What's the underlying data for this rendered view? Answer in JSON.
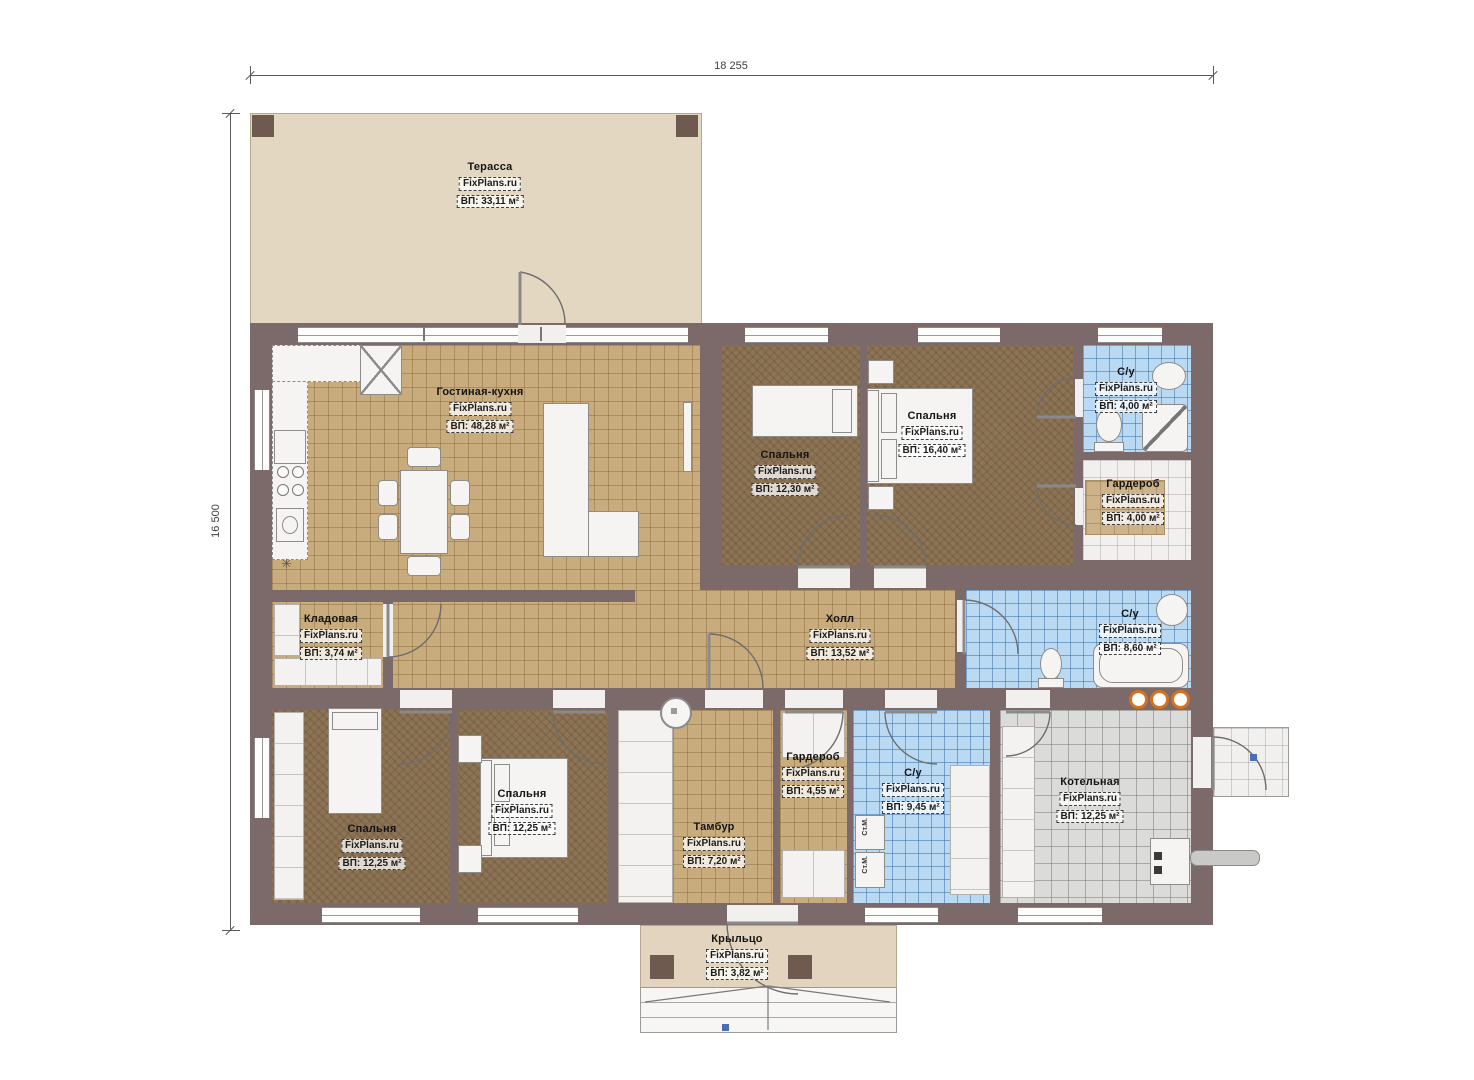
{
  "plan": {
    "dimensions": {
      "top": "18 255",
      "left": "16 500"
    },
    "rooms": [
      {
        "id": "terrace",
        "name": "Терасса",
        "brand": "FixPlans.ru",
        "area": "ВП: 33,11 м²"
      },
      {
        "id": "living-kitchen",
        "name": "Гостиная-кухня",
        "brand": "FixPlans.ru",
        "area": "ВП: 48,28 м²"
      },
      {
        "id": "bedroom-top-left",
        "name": "Спальня",
        "brand": "FixPlans.ru",
        "area": "ВП: 12,30 м²"
      },
      {
        "id": "bedroom-master",
        "name": "Спальня",
        "brand": "FixPlans.ru",
        "area": "ВП: 16,40 м²"
      },
      {
        "id": "bathroom-master",
        "name": "С/у",
        "brand": "FixPlans.ru",
        "area": "ВП: 4,00 м²"
      },
      {
        "id": "wardrobe-master",
        "name": "Гардероб",
        "brand": "FixPlans.ru",
        "area": "ВП: 4,00 м²"
      },
      {
        "id": "pantry",
        "name": "Кладовая",
        "brand": "FixPlans.ru",
        "area": "ВП: 3,74 м²"
      },
      {
        "id": "hall",
        "name": "Холл",
        "brand": "FixPlans.ru",
        "area": "ВП: 13,52 м²"
      },
      {
        "id": "bathroom-main",
        "name": "С/у",
        "brand": "FixPlans.ru",
        "area": "ВП: 8,60 м²"
      },
      {
        "id": "bedroom-bottom-left",
        "name": "Спальня",
        "brand": "FixPlans.ru",
        "area": "ВП: 12,25 м²"
      },
      {
        "id": "bedroom-bottom-mid",
        "name": "Спальня",
        "brand": "FixPlans.ru",
        "area": "ВП: 12,25 м²"
      },
      {
        "id": "wardrobe-bottom",
        "name": "Гардероб",
        "brand": "FixPlans.ru",
        "area": "ВП: 4,55 м²"
      },
      {
        "id": "vestibule",
        "name": "Тамбур",
        "brand": "FixPlans.ru",
        "area": "ВП: 7,20 м²"
      },
      {
        "id": "bathroom-laundry",
        "name": "С/у",
        "brand": "FixPlans.ru",
        "area": "ВП: 9,45 м²"
      },
      {
        "id": "boiler-room",
        "name": "Котельная",
        "brand": "FixPlans.ru",
        "area": "ВП: 12,25 м²"
      },
      {
        "id": "porch",
        "name": "Крыльцо",
        "brand": "FixPlans.ru",
        "area": "ВП: 3,82 м²"
      }
    ],
    "appliances": {
      "washing_machine": "Ст.М."
    },
    "symbols": {
      "kitchen_star": "✳"
    },
    "colors": {
      "wall": "#7C6969",
      "floor_tan": "#C8AC7D",
      "floor_dark": "#8D7456",
      "tile_blue": "#BADAF4",
      "tile_gray": "#DBDBD9",
      "terrace": "#E4D7C2",
      "accent_orange": "#D4731F",
      "marker_blue": "#4A6FB5"
    }
  }
}
